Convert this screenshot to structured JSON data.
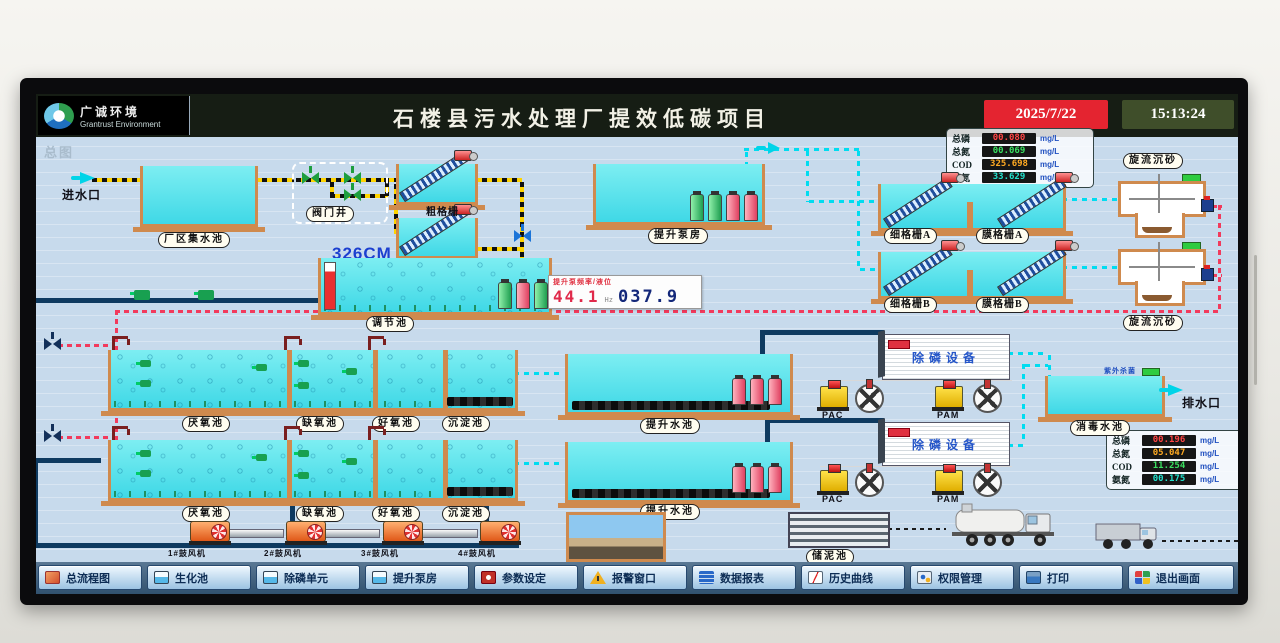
{
  "header": {
    "logo_cn": "广诚环境",
    "logo_en": "Grantrust Environment",
    "title": "石楼县污水处理厂提效低碳项目",
    "date": "2025/7/22",
    "time": "15:13:24",
    "page_tag": "总图"
  },
  "influent_panel": {
    "rows": [
      {
        "label": "总磷",
        "value": "00.080",
        "unit": "mg/L",
        "color": "#ff4545"
      },
      {
        "label": "总氮",
        "value": "00.069",
        "unit": "mg/L",
        "color": "#3ae060"
      },
      {
        "label": "COD",
        "value": "325.698",
        "unit": "mg/L",
        "color": "#ffaa22"
      },
      {
        "label": "氨氮",
        "value": "33.629",
        "unit": "mg/L",
        "color": "#22e0cc"
      }
    ]
  },
  "effluent_panel": {
    "rows": [
      {
        "label": "总磷",
        "value": "00.196",
        "unit": "mg/L",
        "color": "#ff4545"
      },
      {
        "label": "总氮",
        "value": "05.047",
        "unit": "mg/L",
        "color": "#ffaa22"
      },
      {
        "label": "COD",
        "value": "11.254",
        "unit": "mg/L",
        "color": "#3ae060"
      },
      {
        "label": "氨氮",
        "value": "00.175",
        "unit": "mg/L",
        "color": "#22e0cc"
      }
    ]
  },
  "regulation_display": {
    "caption": "提升泵频率/液位",
    "frequency": "44.1",
    "freq_unit": "Hz",
    "level": "037.9"
  },
  "labels": {
    "inlet": "进水口",
    "collection_tank": "厂区集水池",
    "valve_well": "阀门井",
    "coarse_screen": "粗格栅",
    "level_326": "326CM",
    "regulation_tank": "调节池",
    "lift_pump_house": "提升泵房",
    "fine_screen_a": "细格栅A",
    "membrane_screen_a": "膜格栅A",
    "fine_screen_b": "细格栅B",
    "membrane_screen_b": "膜格栅B",
    "grit_chamber": "旋流沉砂",
    "anaerobic_tank": "厌氧池",
    "anoxic_tank": "缺氧池",
    "aerobic_tank": "好氧池",
    "sedimentation_tank": "沉淀池",
    "lift_tank": "提升水池",
    "pac": "PAC",
    "pam": "PAM",
    "phosphorus_removal": "除磷设备",
    "disinfection_tank": "消毒水池",
    "uv": "紫外杀菌",
    "outlet": "排水口",
    "sludge_tank": "储泥池",
    "blower1": "1#鼓风机",
    "blower2": "2#鼓风机",
    "blower3": "3#鼓风机",
    "blower4": "4#鼓风机"
  },
  "toolbar": {
    "buttons": [
      {
        "label": "总流程图"
      },
      {
        "label": "生化池"
      },
      {
        "label": "除磷单元"
      },
      {
        "label": "提升泵房"
      },
      {
        "label": "参数设定"
      },
      {
        "label": "报警窗口"
      },
      {
        "label": "数据报表"
      },
      {
        "label": "历史曲线"
      },
      {
        "label": "权限管理"
      },
      {
        "label": "打印"
      },
      {
        "label": "退出画面"
      }
    ]
  }
}
